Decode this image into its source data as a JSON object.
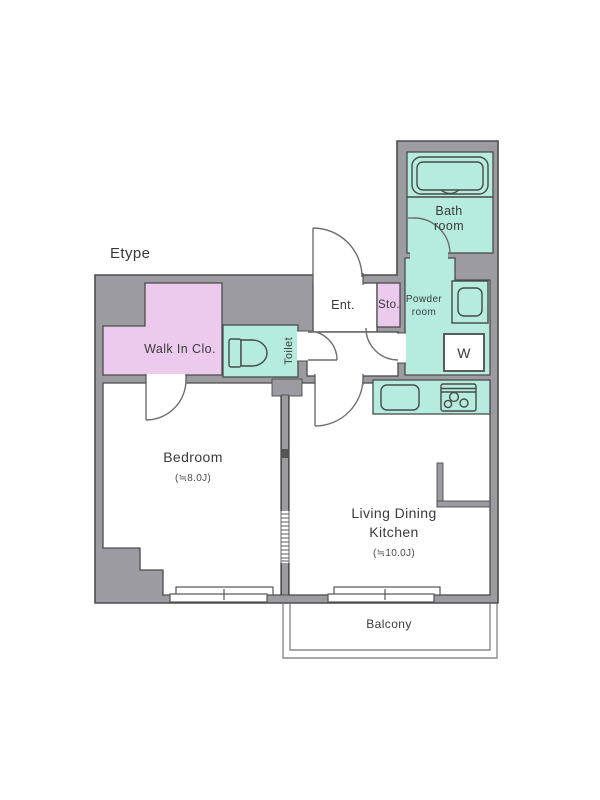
{
  "floorplan": {
    "plan_type": "Etype",
    "labels": {
      "bath_line1": "Bath",
      "bath_line2": "room",
      "powder_line1": "Powder",
      "powder_line2": "room",
      "washer": "W",
      "storage": "Sto.",
      "entrance": "Ent.",
      "toilet": "Toilet",
      "walk_in_closet": "Walk In Clo.",
      "bedroom": "Bedroom",
      "bedroom_size": "(≒8.0J)",
      "ldk_line1": "Living Dining",
      "ldk_line2": "Kitchen",
      "ldk_size": "(≒10.0J)",
      "balcony": "Balcony"
    },
    "colors": {
      "wall_gray": "#9b9ba1",
      "wet_area_teal": "#b5ecdf",
      "closet_pink": "#eccaee",
      "outline_dark": "#4c4c4c",
      "floor_white": "#ffffff"
    }
  }
}
